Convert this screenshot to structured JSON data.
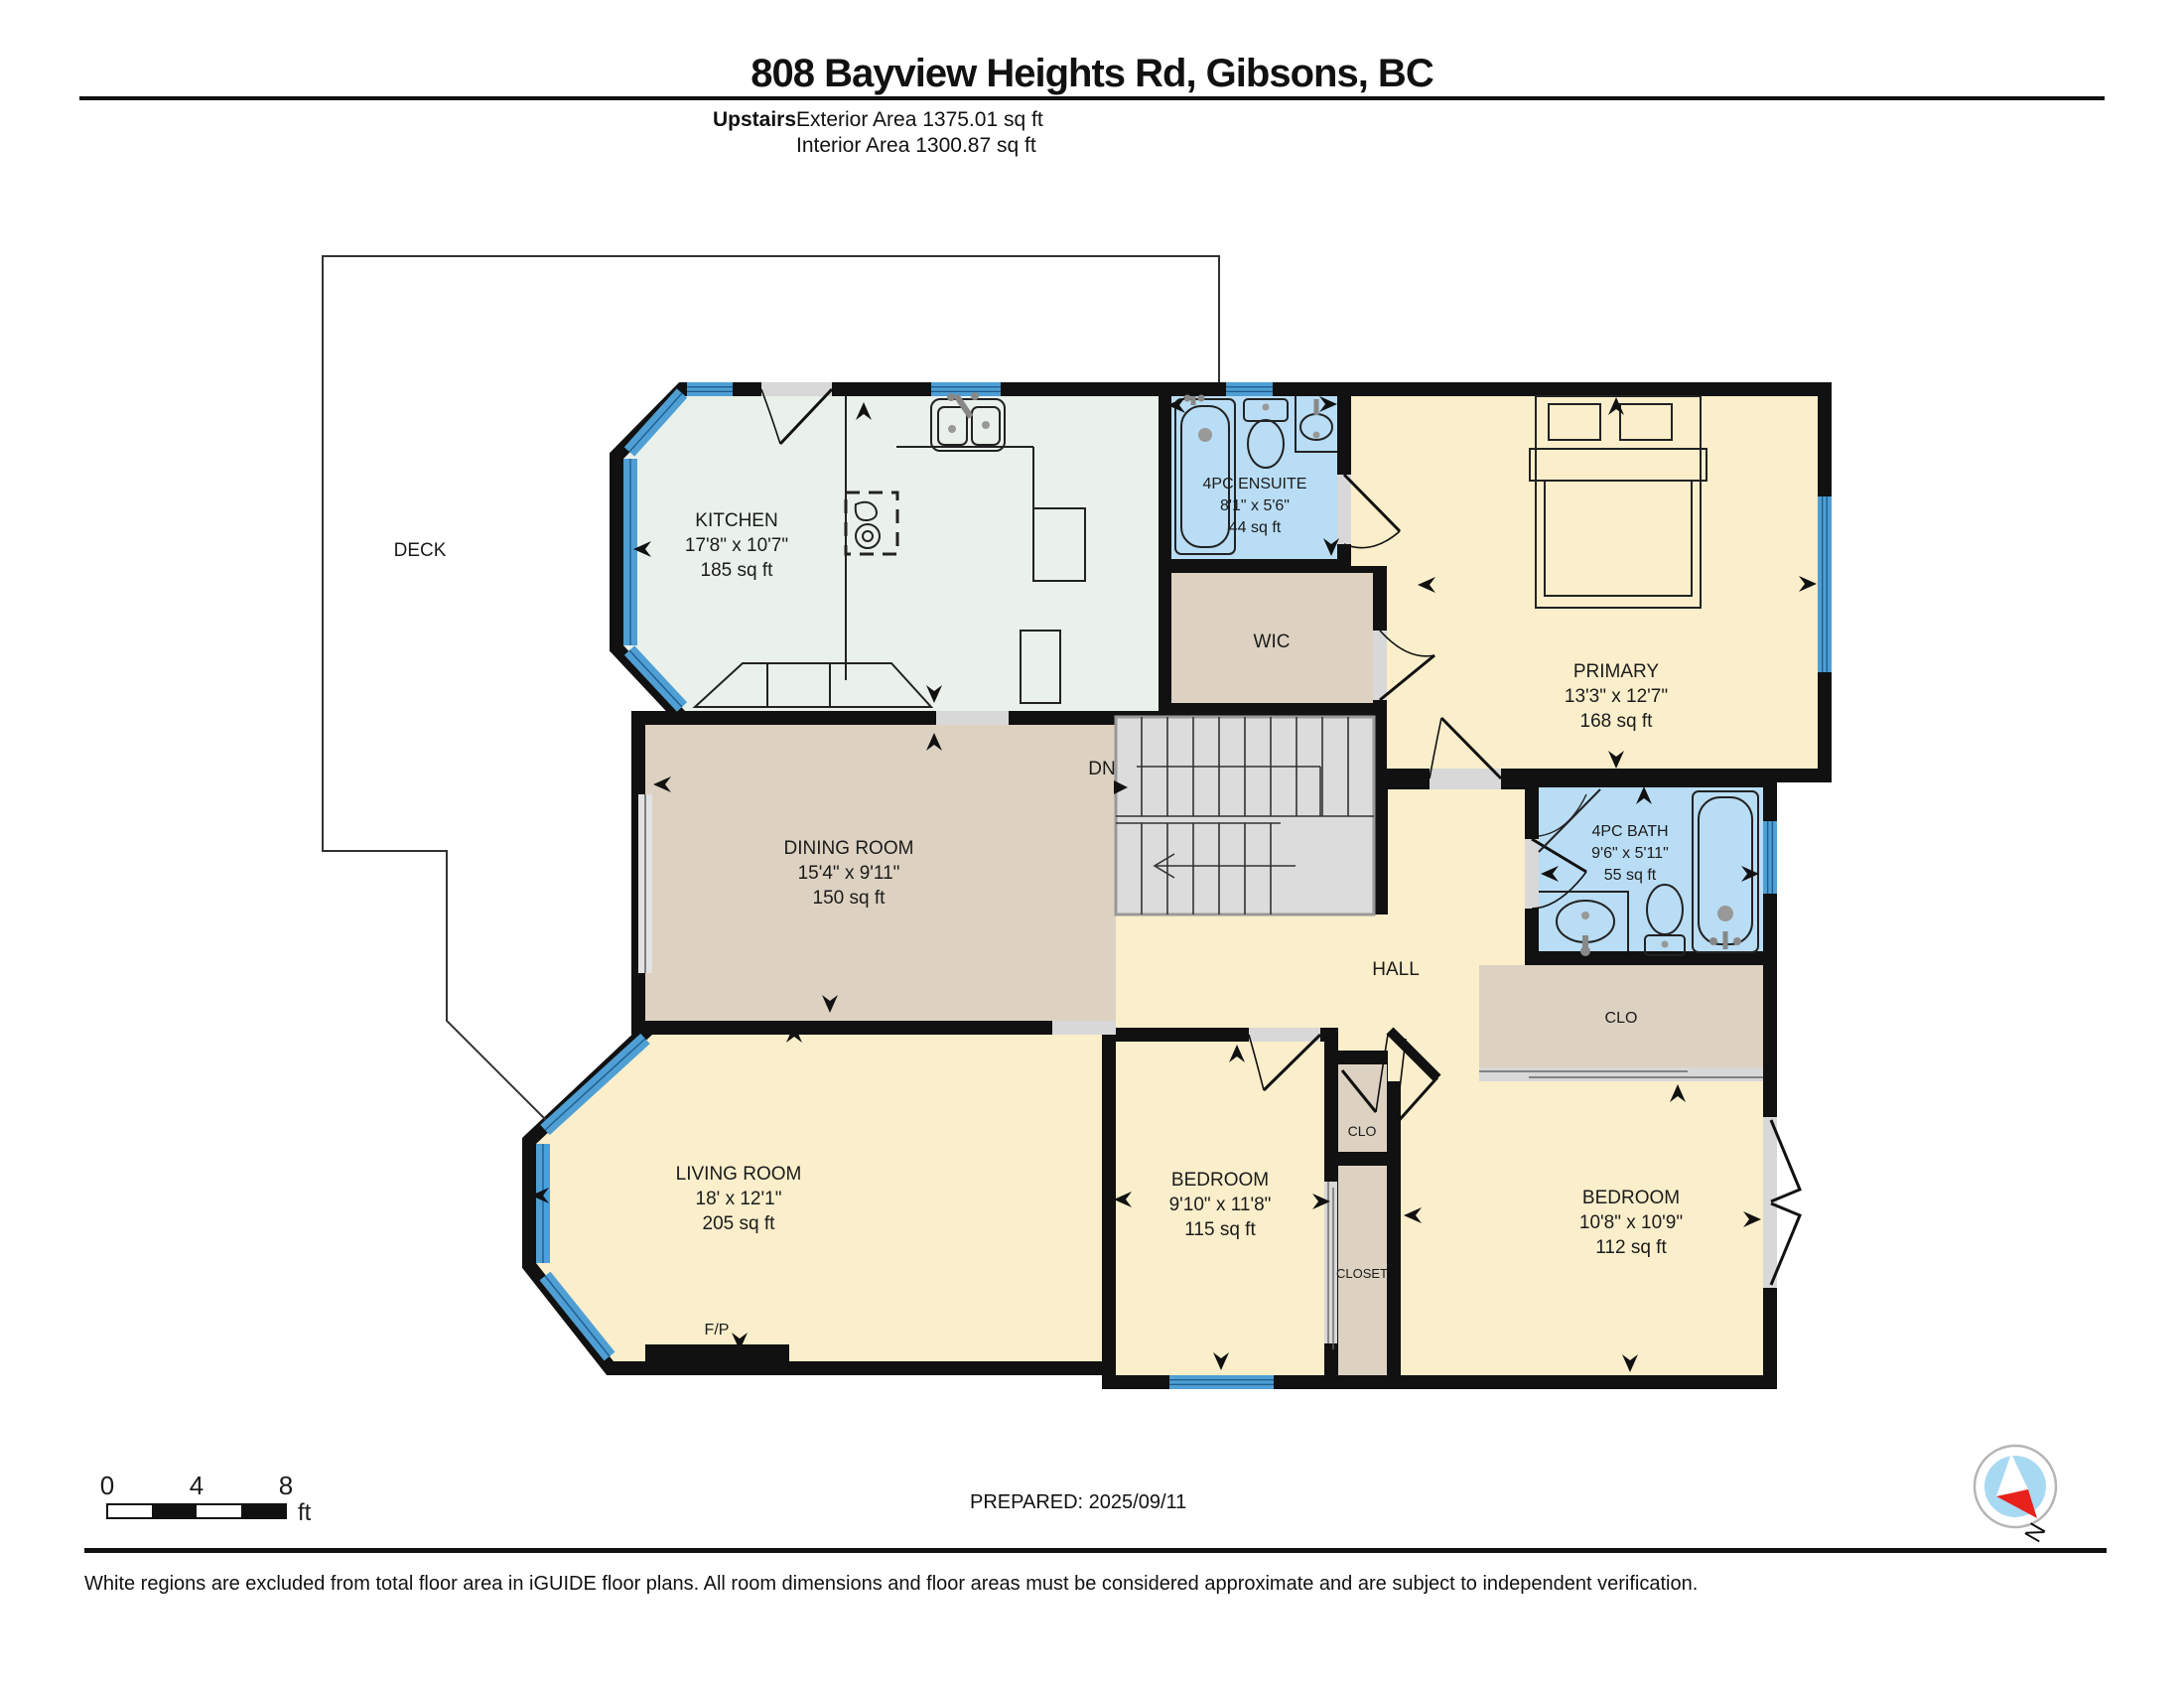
{
  "header": {
    "title": "808 Bayview Heights Rd, Gibsons, BC",
    "floor_label": "Upstairs",
    "exterior_area": "Exterior Area 1375.01 sq ft",
    "interior_area": "Interior Area 1300.87 sq ft"
  },
  "rooms": {
    "deck": {
      "name": "DECK"
    },
    "kitchen": {
      "name": "KITCHEN",
      "dims": "17'8\" x 10'7\"",
      "area": "185 sq ft"
    },
    "ensuite": {
      "name": "4PC ENSUITE",
      "dims": "8'1\" x 5'6\"",
      "area": "44 sq ft"
    },
    "wic": {
      "name": "WIC"
    },
    "primary": {
      "name": "PRIMARY",
      "dims": "13'3\" x 12'7\"",
      "area": "168 sq ft"
    },
    "dining": {
      "name": "DINING ROOM",
      "dims": "15'4\" x 9'11\"",
      "area": "150 sq ft"
    },
    "stairs": {
      "name": "DN"
    },
    "bath": {
      "name": "4PC BATH",
      "dims": "9'6\" x 5'11\"",
      "area": "55 sq ft"
    },
    "hall": {
      "name": "HALL"
    },
    "clo_hall": {
      "name": "CLO"
    },
    "clo_small": {
      "name": "CLO"
    },
    "closet": {
      "name": "CLOSET"
    },
    "bedroom1": {
      "name": "BEDROOM",
      "dims": "9'10\" x 11'8\"",
      "area": "115 sq ft"
    },
    "bedroom2": {
      "name": "BEDROOM",
      "dims": "10'8\" x 10'9\"",
      "area": "112 sq ft"
    },
    "living": {
      "name": "LIVING ROOM",
      "dims": "18' x 12'1\"",
      "area": "205 sq ft"
    },
    "fireplace": {
      "name": "F/P"
    }
  },
  "scale_bar": {
    "ticks": [
      "0",
      "4",
      "8"
    ],
    "unit": "ft"
  },
  "compass": {
    "label": "N"
  },
  "footer": {
    "prepared": "PREPARED: 2025/09/11",
    "disclaimer": "White regions are excluded from total floor area in iGUIDE floor plans. All room dimensions and floor areas must be considered approximate and are subject to independent verification."
  },
  "colors": {
    "wall": "#111111",
    "cream": "#faeecb",
    "tan": "#ddd2c1",
    "green": "#e9f1ea",
    "bath_blue": "#b9ddf4",
    "window_blue": "#4f9fd4",
    "window_line": "#1d5f8f",
    "opening_gray": "#d8d8d8",
    "stair_gray": "#dcdcdc",
    "label": "#1b1b1b",
    "compass_red": "#e8211d",
    "compass_blue": "#a8d9f2"
  }
}
